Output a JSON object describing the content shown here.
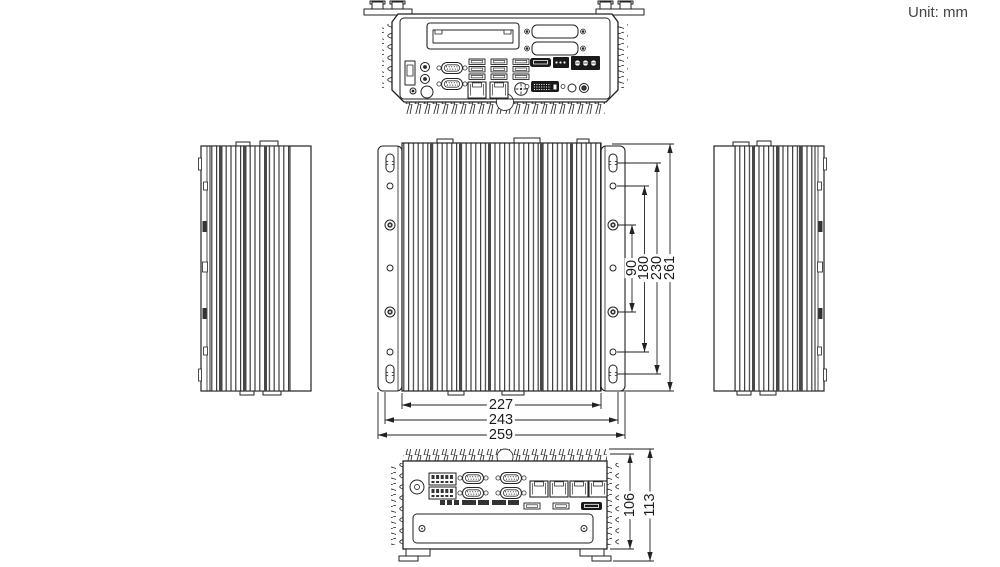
{
  "unit_label": "Unit: mm",
  "colors": {
    "line": "#222222",
    "dark_fill": "#1a1a1a",
    "text": "#1a1a1a",
    "background": "#ffffff"
  },
  "dimensions": {
    "top_width": [
      "227",
      "243",
      "259"
    ],
    "mount_height": [
      "90",
      "180",
      "230",
      "261"
    ],
    "front_height": [
      "106",
      "113"
    ]
  }
}
